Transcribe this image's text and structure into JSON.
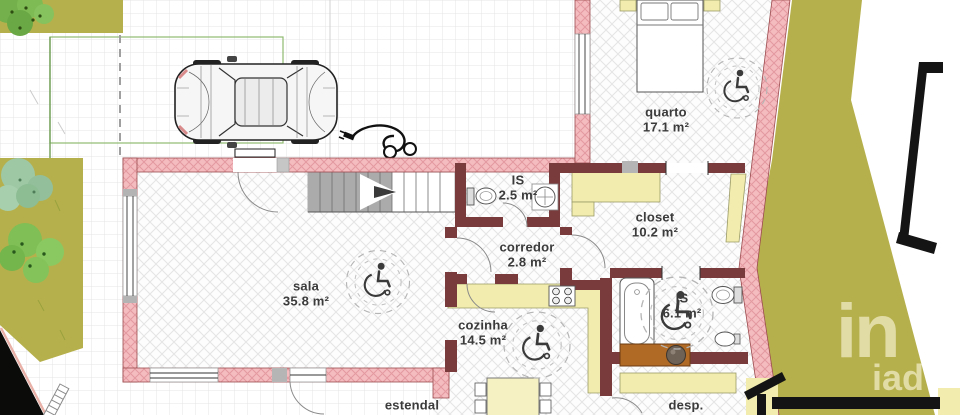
{
  "plan": {
    "rooms": [
      {
        "name": "quarto",
        "area": "17.1 m²"
      },
      {
        "name": "IS",
        "area": "2.5 m²"
      },
      {
        "name": "closet",
        "area": "10.2 m²"
      },
      {
        "name": "corredor",
        "area": "2.8 m²"
      },
      {
        "name": "sala",
        "area": "35.8 m²"
      },
      {
        "name": "cozinha",
        "area": "14.5 m²"
      },
      {
        "name": "IS",
        "area": "6.1 m²"
      },
      {
        "name": "estendal",
        "area": ""
      },
      {
        "name": "desp.",
        "area": ""
      }
    ],
    "watermark": {
      "line1": "in",
      "line2": "iad"
    },
    "symbols": {
      "wheelchair": "wheelchair-accessibility-symbol",
      "ev": "ev-charging-cable",
      "car": "parked-car-top-view"
    },
    "colors": {
      "exterior_wall_pink": "#f4bcbf",
      "wall_hatch_pink": "#e39aa0",
      "interior_wall_maroon": "#7a3b3c",
      "lawn_olive": "#b6b04c",
      "furniture_yellow": "#f2edae",
      "counter_brown": "#b06a25",
      "stairs_gray": "#ababab",
      "neighbor_line_black": "#141414",
      "watermark_text": "#e5dfae",
      "label_text": "#3b3b3b"
    }
  }
}
